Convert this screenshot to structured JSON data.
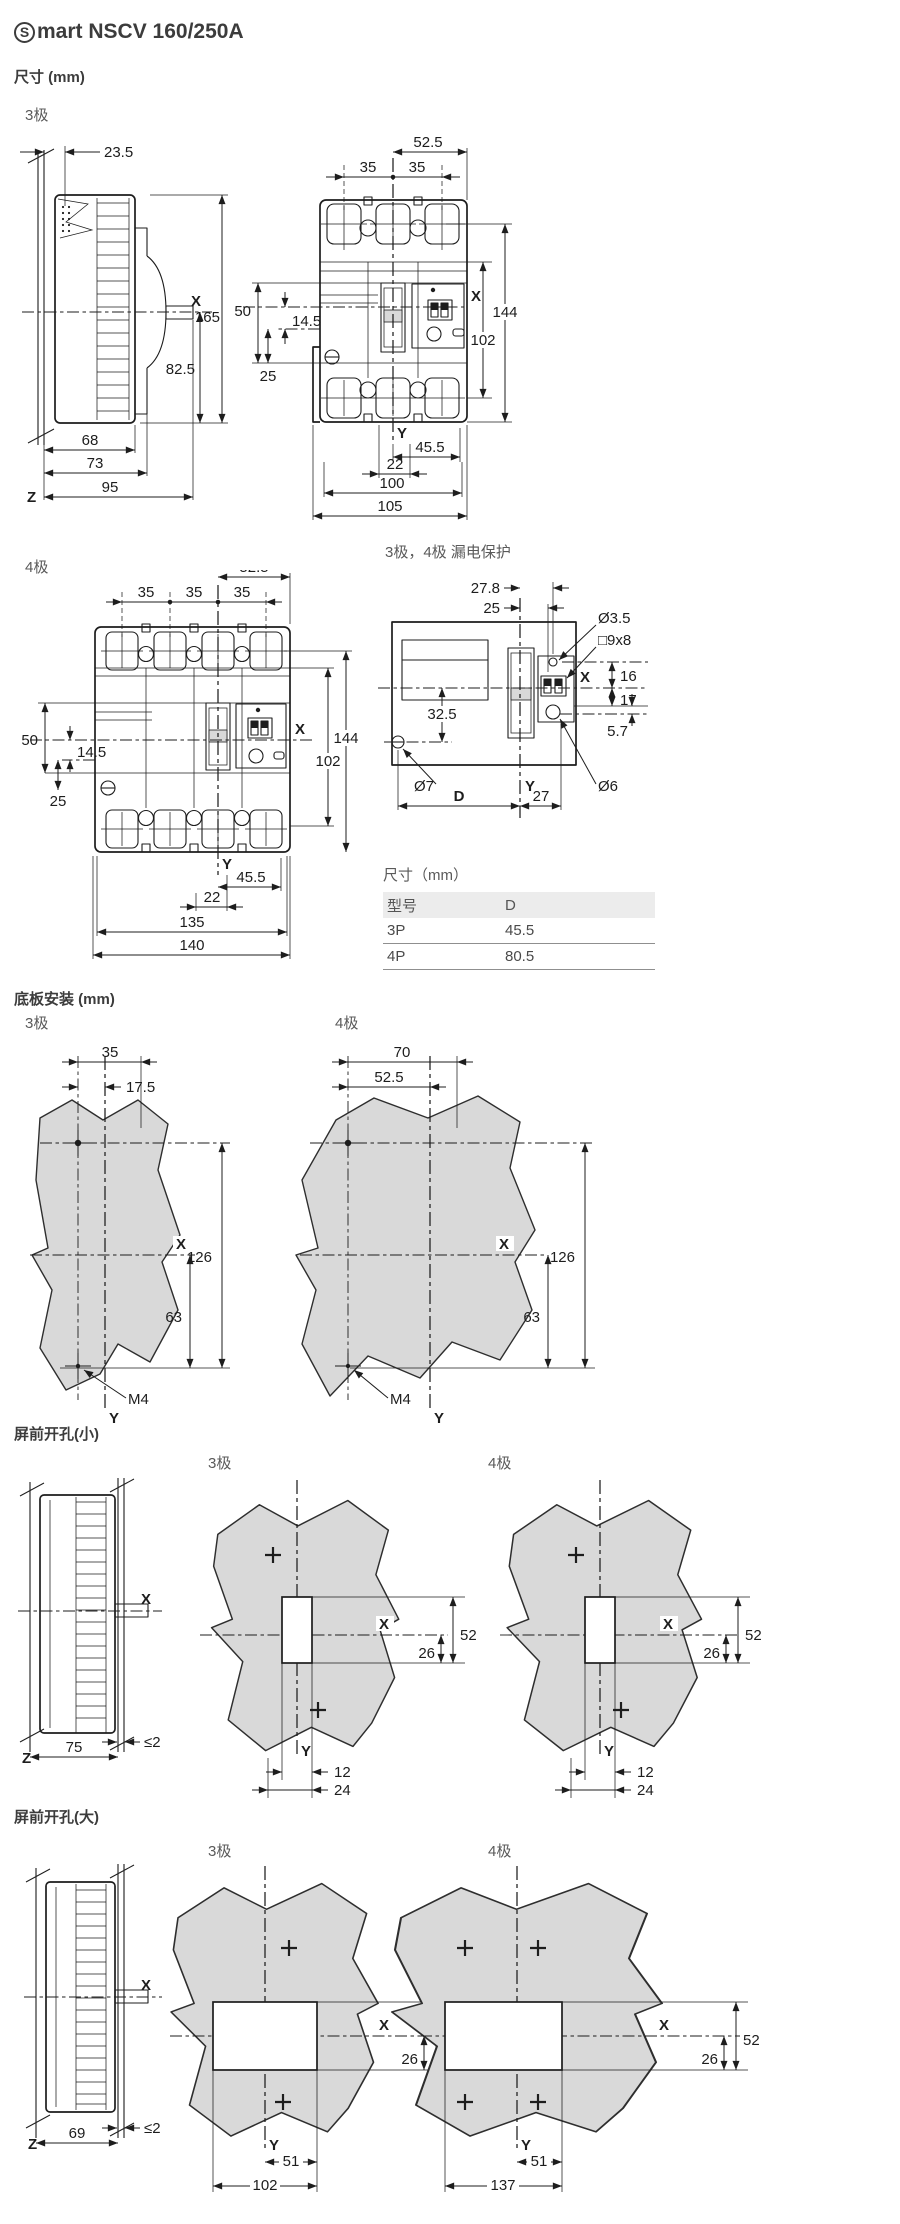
{
  "colors": {
    "line": "#1d1d1d",
    "panel_gray": "#d9d9d9",
    "table_header_bg": "#ececec"
  },
  "header": {
    "logo_glyph": "S",
    "title": "mart NSCV 160/250A"
  },
  "sections": {
    "size": {
      "title": "尺寸 (mm)",
      "pole3_label": "3极",
      "pole4_label": "4极",
      "leakage_label": "3极，4极 漏电保护"
    },
    "base": {
      "title": "底板安装 (mm)",
      "pole3_label": "3极",
      "pole4_label": "4极"
    },
    "small_cutout": {
      "title": "屏前开孔(小)",
      "pole3_label": "3极",
      "pole4_label": "4极"
    },
    "large_cutout": {
      "title": "屏前开孔(大)",
      "pole3_label": "3极",
      "pole4_label": "4极"
    }
  },
  "dims": {
    "side3": {
      "t23_5": "23.5",
      "x": "X",
      "h165": "165",
      "h82_5": "82.5",
      "w68": "68",
      "w73": "73",
      "z": "Z",
      "w95": "95"
    },
    "front3": {
      "t52_5": "52.5",
      "p35l": "35",
      "p35r": "35",
      "l50": "50",
      "l14_5": "14.5",
      "l25": "25",
      "x": "X",
      "r144": "144",
      "r102": "102",
      "y": "Y",
      "b45_5": "45.5",
      "b22": "22",
      "b100": "100",
      "b105": "105"
    },
    "front4": {
      "t52_5": "52.5",
      "p35a": "35",
      "p35b": "35",
      "p35c": "35",
      "l50": "50",
      "l14_5": "14.5",
      "l25": "25",
      "x": "X",
      "r144": "144",
      "r102": "102",
      "y": "Y",
      "b45_5": "45.5",
      "b22": "22",
      "b135": "135",
      "b140": "140"
    },
    "leak": {
      "t27_8": "27.8",
      "t25": "25",
      "d3_5": "Ø3.5",
      "s9x8": "□9x8",
      "x": "X",
      "r16": "16",
      "r17": "17",
      "r5_7": "5.7",
      "l32_5": "32.5",
      "d7": "Ø7",
      "y": "Y",
      "d6": "Ø6",
      "bD": "D",
      "b27": "27"
    },
    "base3": {
      "t35": "35",
      "t17_5": "17.5",
      "r126": "126",
      "r63": "63",
      "x": "X",
      "y": "Y",
      "m4": "M4"
    },
    "base4": {
      "t70": "70",
      "t52_5": "52.5",
      "r126": "126",
      "r63": "63",
      "x": "X",
      "y": "Y",
      "m4": "M4"
    },
    "cutsmall_side": {
      "x": "X",
      "z": "Z",
      "w75": "75",
      "gap": "≤2"
    },
    "cutsmall3": {
      "x": "X",
      "h52": "52",
      "h26": "26",
      "y": "Y",
      "b12": "12",
      "b24": "24"
    },
    "cutsmall4": {
      "x": "X",
      "h52": "52",
      "h26": "26",
      "y": "Y",
      "b12": "12",
      "b24": "24"
    },
    "cutlarge_side": {
      "x": "X",
      "z": "Z",
      "w69": "69",
      "gap": "≤2"
    },
    "cutlarge3": {
      "x": "X",
      "h52": "52",
      "h26": "26",
      "y": "Y",
      "b51": "51",
      "b102": "102"
    },
    "cutlarge4": {
      "x": "X",
      "h52": "52",
      "h26": "26",
      "y": "Y",
      "b51": "51",
      "b137": "137"
    }
  },
  "table": {
    "title": "尺寸（mm）",
    "columns": [
      "型号",
      "D"
    ],
    "rows": [
      [
        "3P",
        "45.5"
      ],
      [
        "4P",
        "80.5"
      ]
    ]
  }
}
